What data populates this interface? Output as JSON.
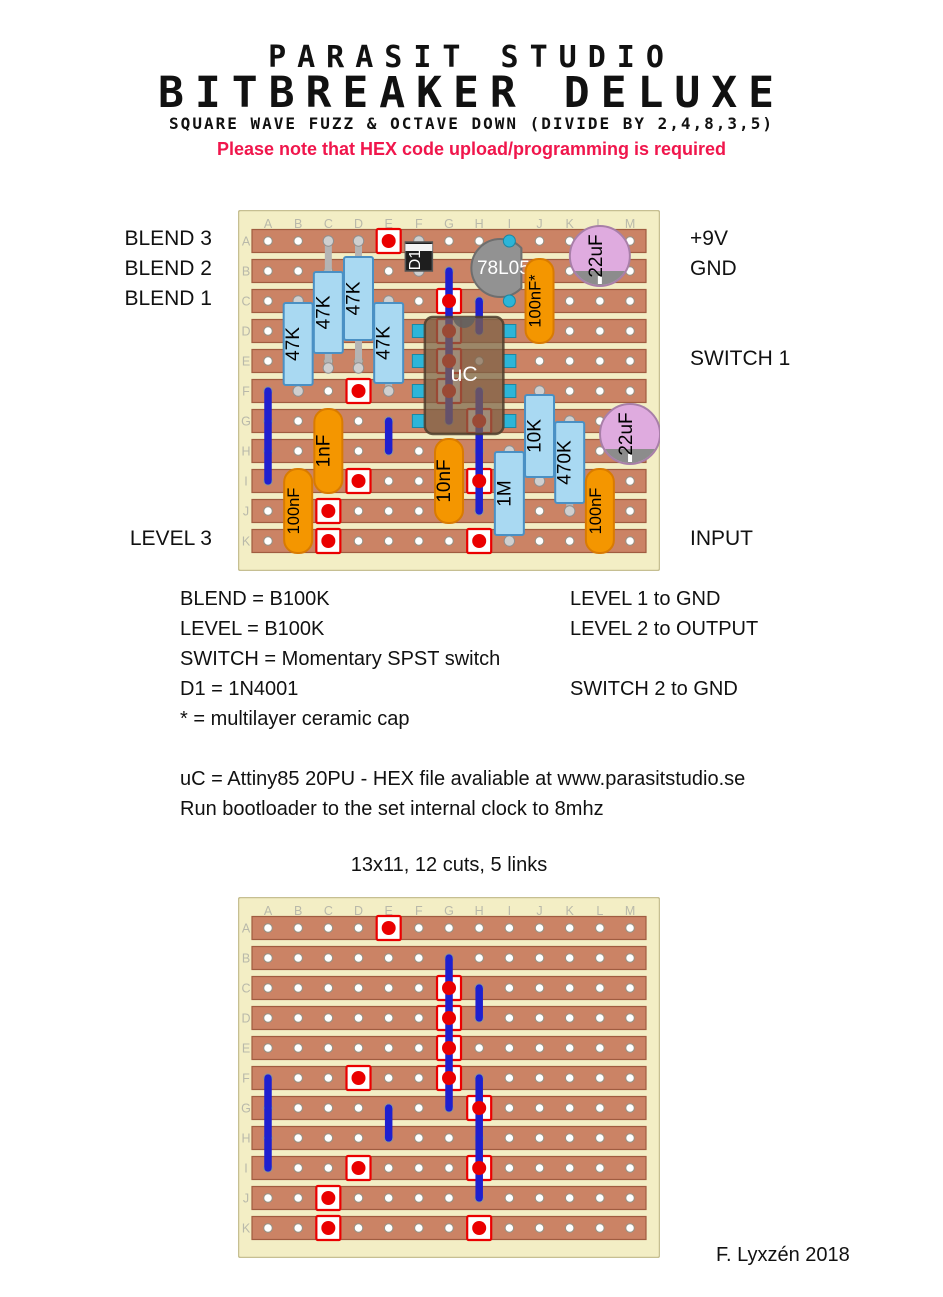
{
  "header": {
    "studio": "PARASIT STUDIO",
    "title": "BITBREAKER DELUXE",
    "subtitle": "SQUARE WAVE FUZZ & OCTAVE DOWN (DIVIDE BY 2,4,8,3,5)",
    "note": "Please note that HEX code upload/programming is required"
  },
  "board_labels": {
    "left": [
      {
        "text": "BLEND 3",
        "row": "A"
      },
      {
        "text": "BLEND 2",
        "row": "B"
      },
      {
        "text": "BLEND 1",
        "row": "C"
      },
      {
        "text": "LEVEL 3",
        "row": "K"
      }
    ],
    "right": [
      {
        "text": "+9V",
        "row": "A"
      },
      {
        "text": "GND",
        "row": "B"
      },
      {
        "text": "SWITCH 1",
        "row": "E"
      },
      {
        "text": "INPUT",
        "row": "K"
      }
    ]
  },
  "legend": {
    "left": [
      "BLEND = B100K",
      "LEVEL = B100K",
      "SWITCH = Momentary SPST switch",
      "D1 = 1N4001",
      "* = multilayer ceramic cap"
    ],
    "right": [
      "LEVEL 1 to GND",
      "LEVEL 2 to OUTPUT",
      "SWITCH 2 to GND"
    ]
  },
  "uc_notes": [
    "uC = Attiny85 20PU - HEX file avaliable at www.parasitstudio.se",
    "Run bootloader to the set internal clock to 8mhz"
  ],
  "bottom_caption": "13x11, 12 cuts, 5 links",
  "footer": "F. Lyxzén 2018",
  "board": {
    "columns": [
      "A",
      "B",
      "C",
      "D",
      "E",
      "F",
      "G",
      "H",
      "I",
      "J",
      "K",
      "L",
      "M"
    ],
    "rows": [
      "A",
      "B",
      "C",
      "D",
      "E",
      "F",
      "G",
      "H",
      "I",
      "J",
      "K"
    ],
    "cuts": [
      [
        "E",
        "A"
      ],
      [
        "G",
        "C"
      ],
      [
        "G",
        "D"
      ],
      [
        "G",
        "E"
      ],
      [
        "G",
        "F"
      ],
      [
        "D",
        "F"
      ],
      [
        "H",
        "G"
      ],
      [
        "D",
        "I"
      ],
      [
        "H",
        "I"
      ],
      [
        "C",
        "J"
      ],
      [
        "C",
        "K"
      ],
      [
        "H",
        "K"
      ]
    ],
    "links": [
      [
        "A",
        "F",
        "I"
      ],
      [
        "G",
        "B",
        "G"
      ],
      [
        "H",
        "C",
        "D"
      ],
      [
        "E",
        "G",
        "H"
      ],
      [
        "H",
        "F",
        "J"
      ]
    ],
    "components": [
      {
        "type": "resistor",
        "label": "47K",
        "col": "B",
        "legs": [
          "C",
          "F"
        ],
        "body": [
          93,
          175
        ]
      },
      {
        "type": "resistor",
        "label": "47K",
        "col": "C",
        "legs": [
          "A",
          "F"
        ],
        "body": [
          62,
          143
        ],
        "stick_to": 158
      },
      {
        "type": "resistor",
        "label": "47K",
        "col": "D",
        "legs": [
          "A",
          "F"
        ],
        "body": [
          47,
          130
        ],
        "stick_to": 158
      },
      {
        "type": "resistor",
        "label": "47K",
        "col": "E",
        "legs": [
          "C",
          "F"
        ],
        "body": [
          93,
          173
        ]
      },
      {
        "type": "diode",
        "label": "D1",
        "col": "F",
        "rows": [
          "A",
          "B"
        ]
      },
      {
        "type": "regulator",
        "label": "78L05",
        "center": [
          "I",
          "B"
        ],
        "dx": -9,
        "dy": -3,
        "r": 29,
        "pins": [
          [
            "I",
            "A"
          ],
          [
            "I",
            "C"
          ]
        ]
      },
      {
        "type": "cap",
        "label": "100nF*",
        "col": "J",
        "rows": [
          "B",
          "D"
        ]
      },
      {
        "type": "elco",
        "label": "22uF",
        "center": [
          "L",
          "A"
        ],
        "dy": 15,
        "r": 30
      },
      {
        "type": "cap",
        "label": "1nF",
        "col": "C",
        "rows": [
          "G",
          "I"
        ]
      },
      {
        "type": "cap",
        "label": "100nF",
        "col": "B",
        "rows": [
          "I",
          "K"
        ]
      },
      {
        "type": "cap",
        "label": "10nF",
        "col": "G",
        "rows": [
          "H",
          "J"
        ]
      },
      {
        "type": "resistor",
        "label": "1M",
        "col": "I",
        "legs": [
          "H",
          "K"
        ],
        "body": [
          242,
          325
        ]
      },
      {
        "type": "resistor",
        "label": "10K",
        "col": "J",
        "legs": [
          "F",
          "I"
        ],
        "body": [
          185,
          267
        ]
      },
      {
        "type": "resistor",
        "label": "470K",
        "col": "K",
        "legs": [
          "G",
          "J"
        ],
        "body": [
          212,
          293
        ]
      },
      {
        "type": "cap",
        "label": "100nF",
        "col": "L",
        "rows": [
          "I",
          "K"
        ]
      },
      {
        "type": "elco",
        "label": "22uF",
        "center": [
          "M",
          "G"
        ],
        "dy": 13,
        "r": 30
      },
      {
        "type": "ic",
        "label": "uC",
        "pin_cols": [
          "F",
          "I"
        ],
        "pin_rows": [
          "D",
          "E",
          "F",
          "G"
        ]
      }
    ]
  },
  "colors": {
    "board": "#f3eec5",
    "board_edge": "#c6bf92",
    "strip": "#cb8365",
    "strip_edge": "#a05c40",
    "hole_edge": "#999386",
    "letter": "#b9b9aa",
    "cut": "#ea0000",
    "link": "#1f1fcf",
    "leg": "#b4b4b4",
    "leg_fill": "#cfcfcf",
    "leg_edge": "#8f8f8f",
    "res": "#a9d9f2",
    "res_edge": "#4a90c4",
    "cap": "#f49600",
    "cap_edge": "#d97b00",
    "elco": "#dfabdf",
    "elco_edge": "#a87fa8",
    "sleeve": "#8c8c8c",
    "diode": "#1e1e1e",
    "diode_edge": "#555555",
    "reg": "#929292",
    "reg_edge": "#6e6e6e",
    "pin": "#2cb5d8",
    "pin_edge": "#1b87a3",
    "ic": "#7d6248",
    "ic_edge": "#4e3d2c",
    "notch": "#606060"
  }
}
